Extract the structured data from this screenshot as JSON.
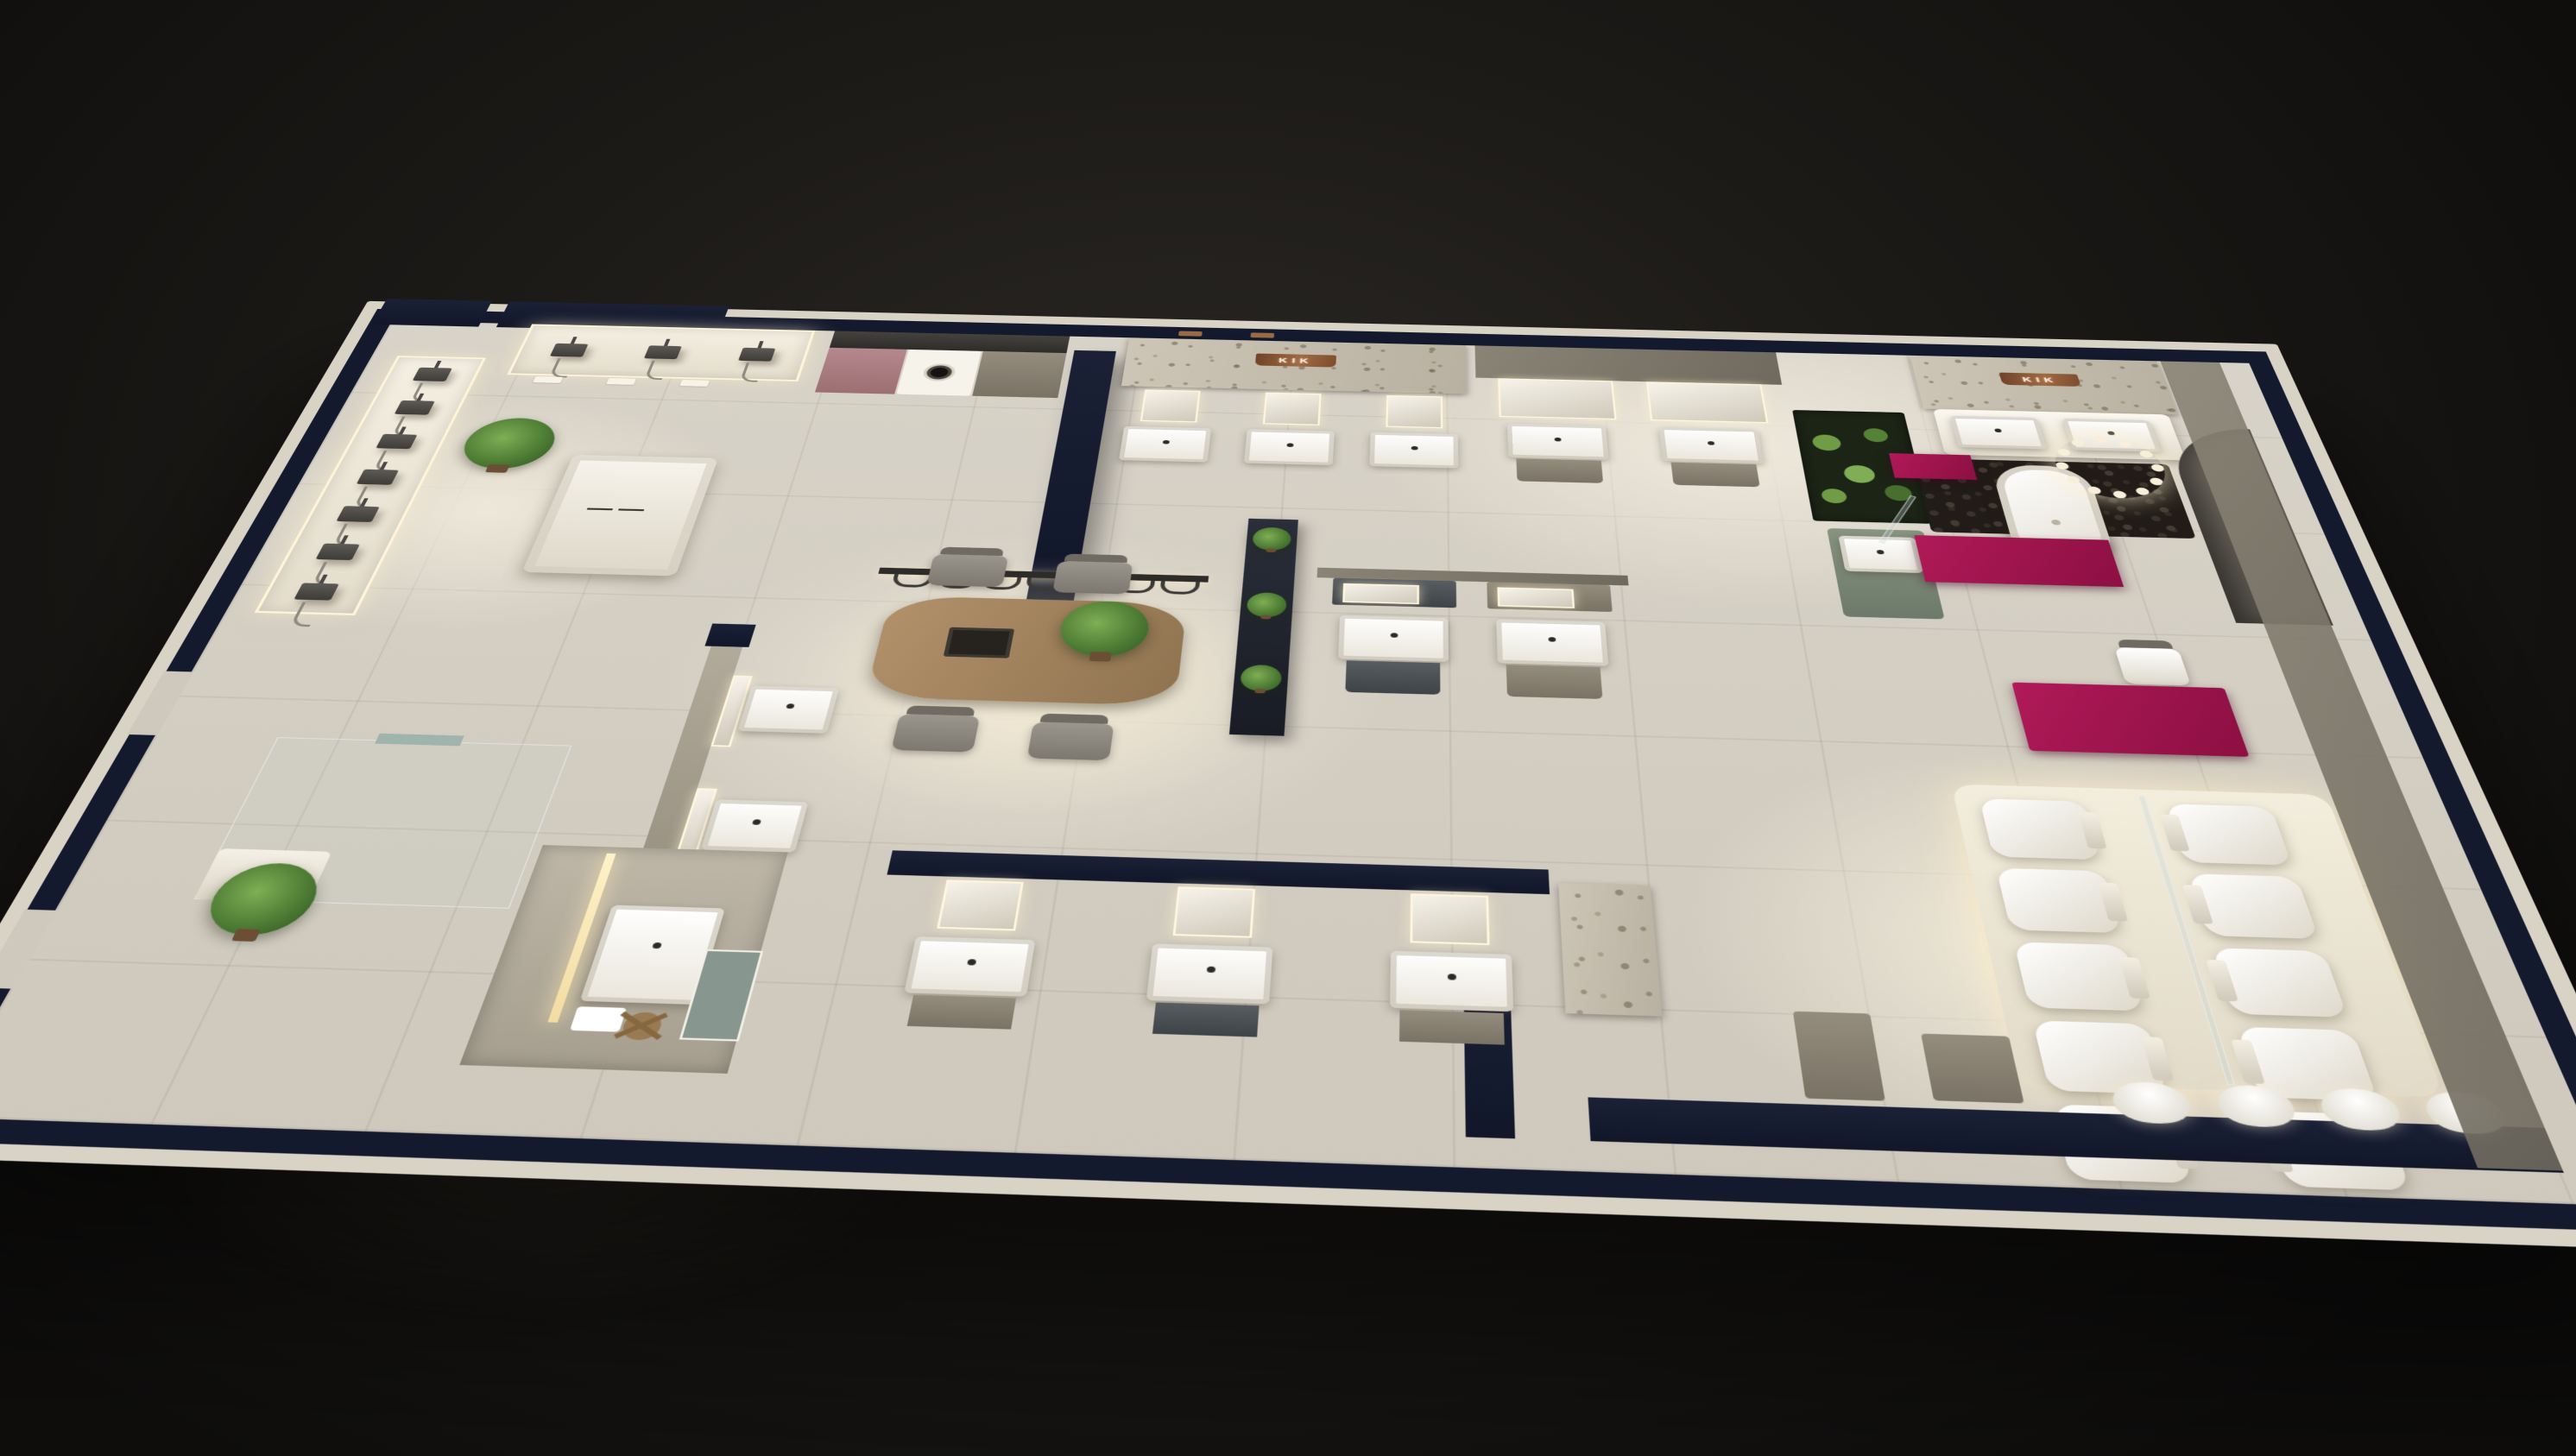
{
  "scene": {
    "subject": "Aerial 3D render of a KIK bathroom-fixtures showroom at night",
    "brand_signs": {
      "center_wall_sign": "KIK",
      "right_wall_sign": "KIK"
    },
    "palette": {
      "background_center": "#2c2925",
      "background_edge": "#0e0d0c",
      "wall_top_navy": "#131a2e",
      "wall_outer_face": "#d9d3c6",
      "floor_tile": "#d7d2c7",
      "feature_gray_wall": "#7f7a6d",
      "marble_wall": "#c4bcac",
      "accent_magenta": "#a1164f",
      "accent_pink_cabinet": "#b08184",
      "accent_teal_panel": "#8da099",
      "copper_sign": "#9a6a42",
      "led_glow": "#ffedc2",
      "plant_green": "#5c8a3e",
      "wood_table": "#a4845c",
      "fixture_white": "#f4f1e9",
      "cabinet_dark": "#4c5157",
      "cabinet_taupe": "#8d8679",
      "chair_gray": "#8f8c86"
    },
    "counts": {
      "shower_heads_west": 7,
      "shower_heads_north": 3,
      "spec_cards_north": 3,
      "toilet_units": 10,
      "south_wall_basins": 4,
      "pendant_hooks": 7,
      "dining_chairs": 4,
      "vanity_bays_center_wall": 3,
      "vanity_bays_south_wall": 3
    }
  }
}
